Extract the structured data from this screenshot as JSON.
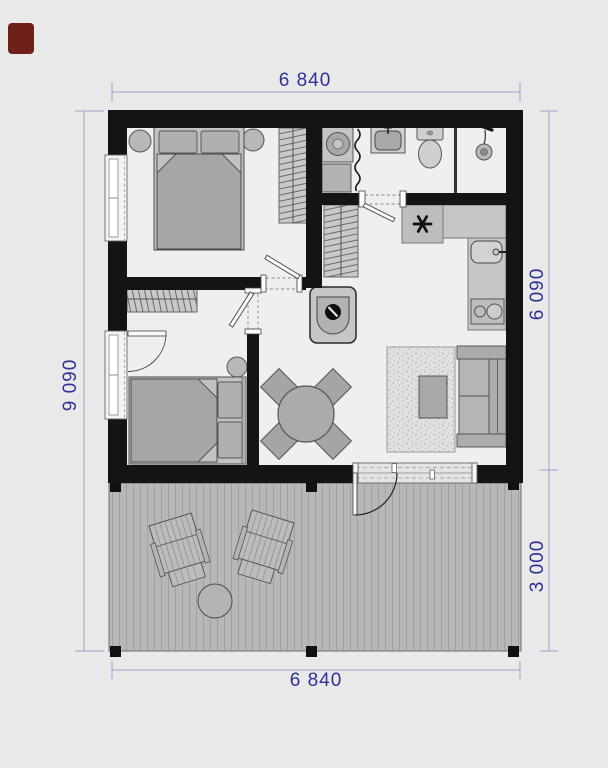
{
  "page": {
    "background": "#e9e9e9"
  },
  "dimensions": {
    "top": "6 840",
    "bottom": "6 840",
    "left": "9 090",
    "right_upper": "6 090",
    "right_lower": "3 000"
  },
  "colors": {
    "wall": "#141414",
    "floor": "#efefef",
    "furniture_gray": "#b5b5b5",
    "deck_gray": "#b7b7b7",
    "rug_gray": "#e0e0e0",
    "dimension_text": "#2f3196",
    "dimension_line": "#9a9ec9",
    "cropped_icon_red": "#6f2018"
  },
  "fixtures": [
    "double-bed",
    "pillow",
    "wardrobe",
    "clothes-rail",
    "bedside-lamp",
    "washing-machine",
    "bath-cabinet",
    "shower-curtain",
    "washbasin",
    "toilet",
    "shower-head",
    "shower-drain",
    "kitchen-counter",
    "cooktop-star",
    "kitchen-sink",
    "two-burner-hob",
    "wood-stove",
    "dining-table",
    "dining-chair",
    "area-rug",
    "coffee-table",
    "sofa",
    "sliding-glass-door",
    "entrance-door-swing",
    "window",
    "interior-door",
    "lounge-chair",
    "deck-table",
    "deck-post"
  ]
}
